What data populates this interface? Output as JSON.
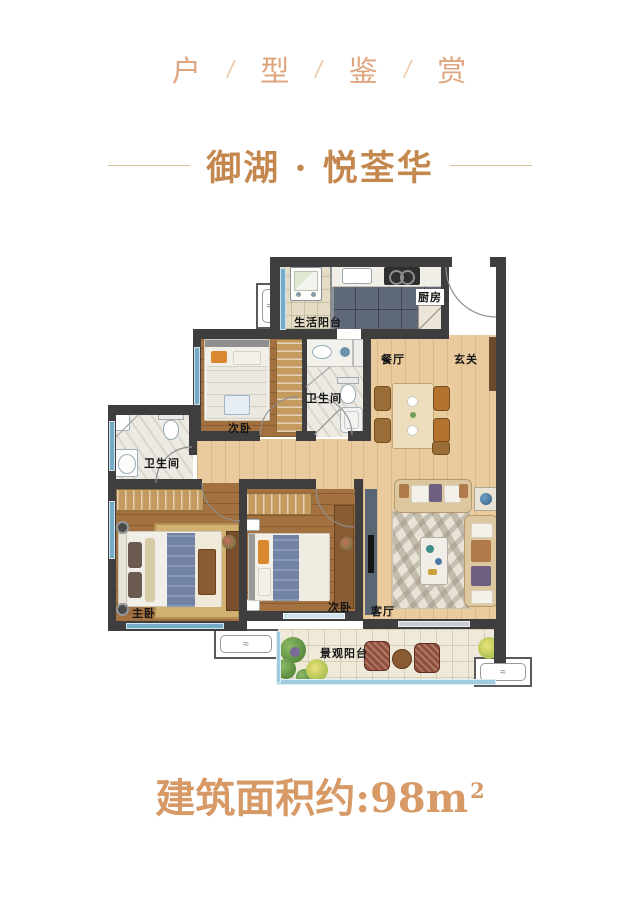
{
  "header": {
    "characters": [
      "户",
      "型",
      "鉴",
      "赏"
    ],
    "separator": "/"
  },
  "title": {
    "text": "御湖 · 悦荃华"
  },
  "floor_plan": {
    "rooms": {
      "service_balcony": {
        "label": "生活阳台"
      },
      "kitchen": {
        "label": "厨房"
      },
      "dining": {
        "label": "餐厅"
      },
      "foyer": {
        "label": "玄关"
      },
      "bathroom_main": {
        "label": "卫生间"
      },
      "bathroom_second": {
        "label": "卫生间"
      },
      "bedroom_second_upper": {
        "label": "次卧"
      },
      "bedroom_second_lower": {
        "label": "次卧"
      },
      "bedroom_master": {
        "label": "主卧"
      },
      "living_room": {
        "label": "客厅"
      },
      "view_balcony": {
        "label": "景观阳台"
      }
    },
    "icons": {
      "ac_unit_symbol": "≈"
    }
  },
  "footer": {
    "area_text": "建筑面积约:98m",
    "area_superscript": "2"
  },
  "theme": {
    "accent": "#c4884f",
    "header_text": "#dfa57e",
    "separator_color": "#ecc9a8",
    "divider_line": "#d9bb96",
    "footer_text": "#d79a67",
    "wall": "#3e3e3e",
    "wood_light": "#e9cb9d",
    "wood_dark": "#a3713f",
    "kitchen_tile": "#5f6977",
    "bath_tile": "#edeae3",
    "service_balcony_tile": "#e5dcc6",
    "view_balcony_tile": "#efe9d9",
    "window_blue": "#74abc9"
  }
}
